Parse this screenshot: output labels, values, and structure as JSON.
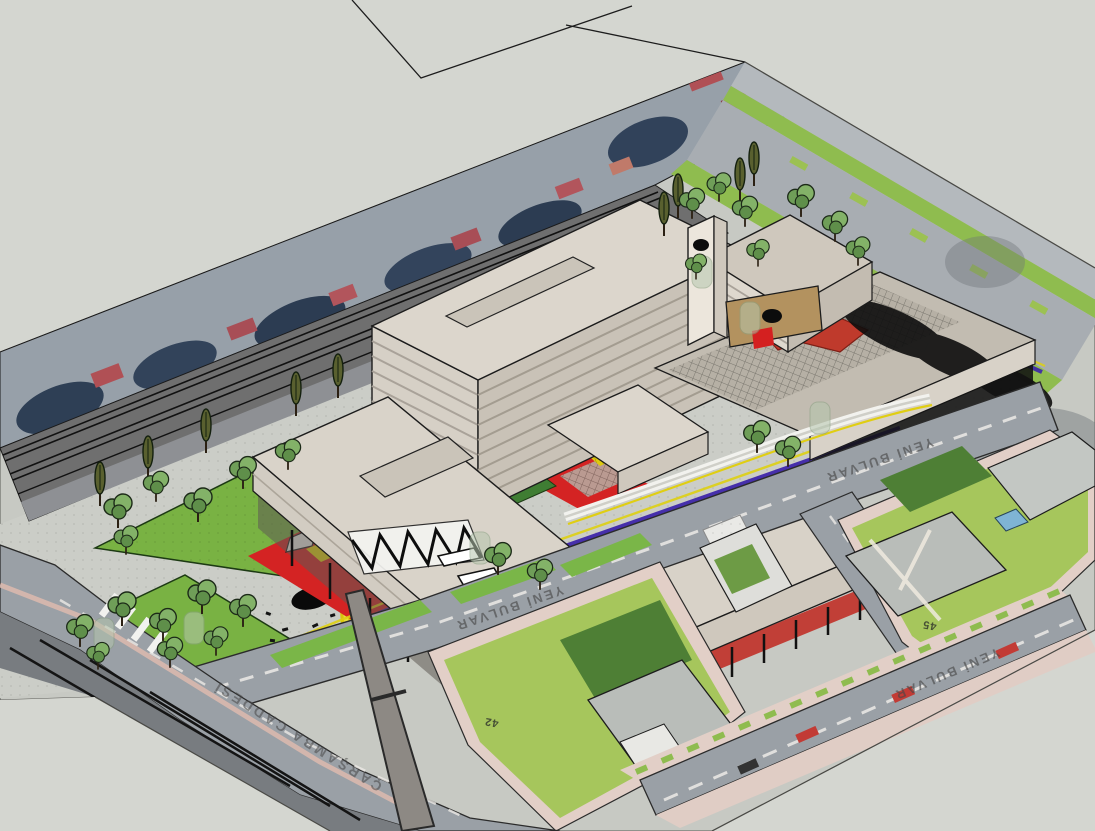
{
  "viewport": {
    "type": "3d-model-viewport",
    "background_color": "#d4d6d0"
  },
  "model": {
    "street_labels": [
      {
        "id": "yeni-bulvar-1",
        "text": "YENİ BULVAR"
      },
      {
        "id": "yeni-bulvar-2",
        "text": "YENİ BULVAR"
      },
      {
        "id": "yeni-bulvar-3",
        "text": "YENİ BULVAR"
      },
      {
        "id": "carsamba-caddesi",
        "text": "ÇARŞAMBA CADDESİ"
      }
    ],
    "parcel_numbers": [
      {
        "id": "parcel-42",
        "text": "42"
      },
      {
        "id": "parcel-45",
        "text": "45"
      }
    ],
    "colors": {
      "background_gray": "#d4d6d0",
      "road_gray": "#9aa0a6",
      "railway_gray": "#6f6f6f",
      "sidewalk_pink": "#e2cfc7",
      "lawn_green": "#79b243",
      "block_lawn_green": "#a6c65c",
      "plaza_red": "#d42323",
      "path_yellow": "#d9c40e",
      "bike_lane_purple": "#3b22a8",
      "building_cream": "#d9d3c9",
      "shadow_black": "#0e0e0e",
      "pool_blue": "#7fb4d4"
    }
  }
}
